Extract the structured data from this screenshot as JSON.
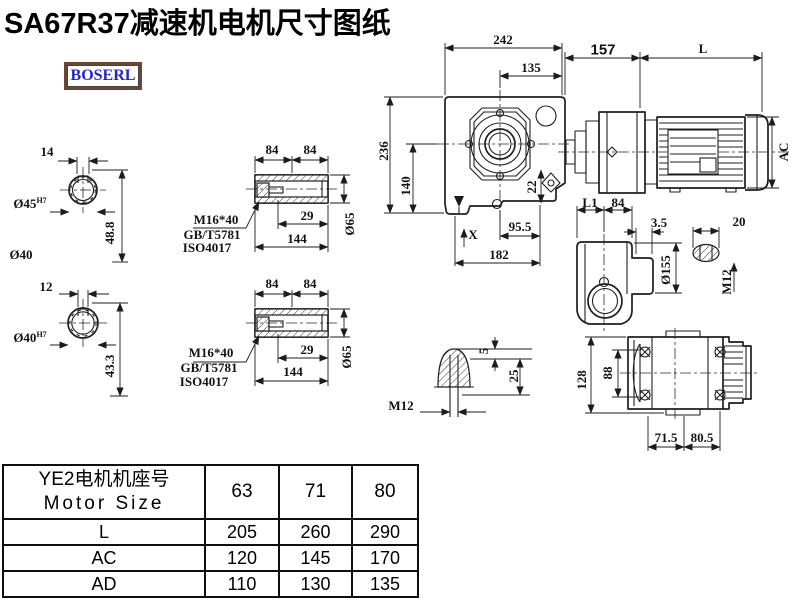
{
  "title": "SA67R37减速机电机尺寸图纸",
  "logo": "BOSERL",
  "colors": {
    "line": "#1f1f1f",
    "logo_text": "#2324c8",
    "logo_border": "#6b4536",
    "accent": "#000000"
  },
  "shaft_section_top": {
    "key_width": "14",
    "bore": "Ø45",
    "bore_tol": "H7",
    "depth": "48.8",
    "shaft_dia": "Ø40"
  },
  "shaft_section_bottom": {
    "key_width": "12",
    "bore": "Ø40",
    "bore_tol": "H7",
    "depth": "43.3"
  },
  "hollow_shaft_top": {
    "len_a": "84",
    "len_b": "84",
    "bolt": "M16*40",
    "std_gb": "GB/T5781",
    "std_iso": "ISO4017",
    "bore_depth": "29",
    "total_len": "144",
    "outer_dia": "Ø65"
  },
  "hollow_shaft_bottom": {
    "len_a": "84",
    "len_b": "84",
    "bolt": "M16*40",
    "std_gb": "GB/T5781",
    "std_iso": "ISO4017",
    "bore_depth": "29",
    "total_len": "144",
    "outer_dia": "Ø65"
  },
  "front_view": {
    "overall_width": "242",
    "flange_offset": "135",
    "overall_height": "236",
    "center_height": "140",
    "foot": "22",
    "hole_span": "95.5",
    "base_width": "182",
    "datum": "X"
  },
  "motor_view": {
    "gear_length": "157",
    "motor_length": "L",
    "motor_dia": "AC"
  },
  "side_view": {
    "dim_l1": "L1",
    "dim_84": "84",
    "dim_3_5": "3.5",
    "dim_20": "20",
    "flange_dia": "Ø155",
    "thread": "M12"
  },
  "plug_detail": {
    "dim_5": "5",
    "dim_25": "25",
    "thread": "M12"
  },
  "bottom_view": {
    "height": "128",
    "inner_height": "88",
    "span_left": "71.5",
    "span_right": "80.5"
  },
  "table": {
    "header_cn": "YE2电机机座号",
    "header_en": "Motor Size",
    "columns": [
      "63",
      "71",
      "80"
    ],
    "rows": [
      {
        "label": "L",
        "values": [
          "205",
          "260",
          "290"
        ]
      },
      {
        "label": "AC",
        "values": [
          "120",
          "145",
          "170"
        ]
      },
      {
        "label": "AD",
        "values": [
          "110",
          "130",
          "135"
        ]
      }
    ]
  }
}
